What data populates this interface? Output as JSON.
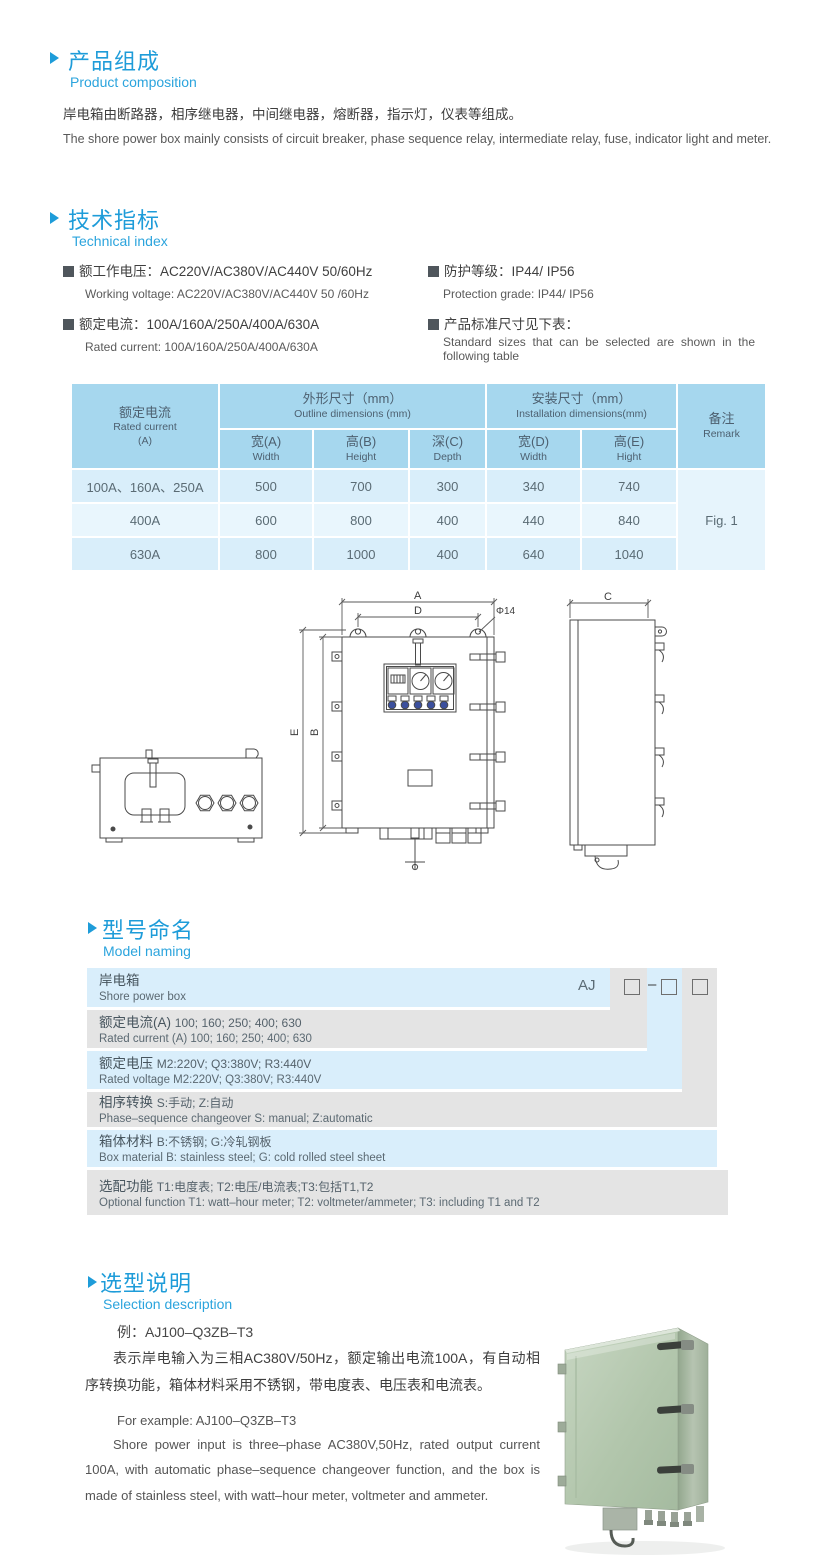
{
  "composition": {
    "title_cn": "产品组成",
    "title_en": "Product  composition",
    "body_cn": "岸电箱由断路器，相序继电器，中间继电器，熔断器，指示灯，仪表等组成。",
    "body_en": "The shore power box mainly consists of circuit breaker, phase sequence relay, intermediate relay, fuse, indicator light and meter."
  },
  "technical": {
    "title_cn": "技术指标",
    "title_en": "Technical index",
    "spec1_cn": "额工作电压：AC220V/AC380V/AC440V  50/60Hz",
    "spec1_en": "Working voltage: AC220V/AC380V/AC440V 50 /60Hz",
    "spec2_cn": "额定电流：100A/160A/250A/400A/630A",
    "spec2_en": "Rated current: 100A/160A/250A/400A/630A",
    "spec3_cn": "防护等级：IP44/ IP56",
    "spec3_en": "Protection grade: IP44/ IP56",
    "spec4_cn": "产品标准尺寸见下表：",
    "spec4_en": "Standard sizes that can be selected are shown in the following table"
  },
  "size_table": {
    "current_header_cn": "额定电流",
    "current_header_en": "Rated current",
    "current_header_unit": "(A)",
    "outline_cn": "外形尺寸（mm）",
    "outline_en": "Outline dimensions (mm)",
    "install_cn": "安装尺寸（mm）",
    "install_en": "Installation dimensions(mm)",
    "remark_cn": "备注",
    "remark_en": "Remark",
    "sub": [
      {
        "cn": "宽(A)",
        "en": "Width"
      },
      {
        "cn": "高(B)",
        "en": "Height"
      },
      {
        "cn": "深(C)",
        "en": "Depth"
      },
      {
        "cn": "宽(D)",
        "en": "Width"
      },
      {
        "cn": "高(E)",
        "en": "Hight"
      }
    ],
    "rows": [
      {
        "current": "100A、160A、250A",
        "w": "500",
        "h": "700",
        "d": "300",
        "iw": "340",
        "ih": "740"
      },
      {
        "current": "400A",
        "w": "600",
        "h": "800",
        "d": "400",
        "iw": "440",
        "ih": "840"
      },
      {
        "current": "630A",
        "w": "800",
        "h": "1000",
        "d": "400",
        "iw": "640",
        "ih": "1040"
      }
    ],
    "remark_value": "Fig. 1"
  },
  "drawing": {
    "dim_a": "A",
    "dim_d": "D",
    "dim_hole": "Φ14",
    "dim_e": "E",
    "dim_b": "B",
    "dim_c": "C"
  },
  "model_naming": {
    "title_cn": "型号命名",
    "title_en": "Model naming",
    "prefix": "AJ",
    "dash": "–",
    "rows": [
      {
        "label_cn": "岸电箱",
        "desc_cn": "",
        "label_en": "Shore power box",
        "desc_en": ""
      },
      {
        "label_cn": "额定电流(A)",
        "desc_cn": "100; 160; 250; 400; 630",
        "label_en": "Rated current (A)",
        "desc_en": "100; 160; 250; 400; 630"
      },
      {
        "label_cn": "额定电压",
        "desc_cn": "M2:220V;  Q3:380V;  R3:440V",
        "label_en": "Rated voltage",
        "desc_en": "M2:220V;  Q3:380V;  R3:440V"
      },
      {
        "label_cn": "相序转换",
        "desc_cn": "S:手动; Z:自动",
        "label_en": "Phase–sequence changeover",
        "desc_en": "S: manual;  Z:automatic"
      },
      {
        "label_cn": "箱体材料",
        "desc_cn": "B:不锈钢;  G:冷轧钢板",
        "label_en": "Box material",
        "desc_en": "B: stainless steel; G: cold rolled steel sheet"
      },
      {
        "label_cn": "选配功能",
        "desc_cn": "T1:电度表;  T2:电压/电流表;T3:包括T1,T2",
        "label_en": "Optional function",
        "desc_en": "T1: watt–hour meter; T2: voltmeter/ammeter; T3: including T1 and T2"
      }
    ]
  },
  "selection": {
    "title_cn": "选型说明",
    "title_en": "Selection description",
    "example_cn": "例：AJ100–Q3ZB–T3",
    "body_cn": "表示岸电输入为三相AC380V/50Hz，额定输出电流100A，有自动相序转换功能，箱体材料采用不锈钢，带电度表、电压表和电流表。",
    "example_en": "For example: AJ100–Q3ZB–T3",
    "body_en": "Shore power input is three–phase AC380V,50Hz, rated output current 100A, with automatic phase–sequence changeover function, and the box is made of stainless steel, with watt–hour meter, voltmeter and ammeter."
  }
}
